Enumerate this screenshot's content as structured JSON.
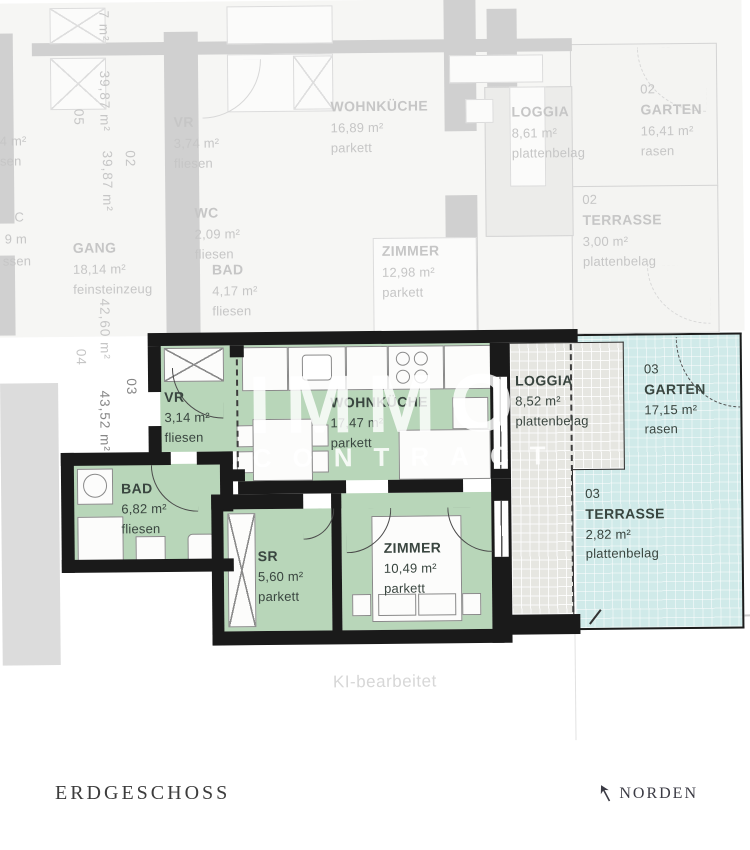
{
  "footer": {
    "floor_label": "ERDGESCHOSS",
    "north_label": "NORDEN"
  },
  "watermark": {
    "line1": "IMMO",
    "line2": "CONTRACT",
    "ai_note": "KI-bearbeitet"
  },
  "colors": {
    "room_green": "#b8d6b9",
    "outdoor_cyan": "#d0eae9",
    "loggia_gray": "#e6e6e1",
    "wall_black": "#1a1a1a"
  },
  "unit": {
    "number": "03",
    "total_area": "43,52 m²",
    "rooms": {
      "vr": {
        "name": "VR",
        "area": "3,14 m²",
        "floor": "fliesen"
      },
      "wohnkueche": {
        "name": "WOHNKÜCHE",
        "area": "17,47 m²",
        "floor": "parkett"
      },
      "loggia": {
        "name": "LOGGIA",
        "area": "8,52 m²",
        "floor": "plattenbelag"
      },
      "garten": {
        "unit": "03",
        "name": "GARTEN",
        "area": "17,15 m²",
        "floor": "rasen"
      },
      "terrasse": {
        "unit": "03",
        "name": "TERRASSE",
        "area": "2,82 m²",
        "floor": "plattenbelag"
      },
      "bad": {
        "name": "BAD",
        "area": "6,82 m²",
        "floor": "fliesen"
      },
      "sr": {
        "name": "SR",
        "area": "5,60 m²",
        "floor": "parkett"
      },
      "zimmer": {
        "name": "ZIMMER",
        "area": "10,49 m²",
        "floor": "parkett"
      }
    }
  },
  "faded": {
    "rooms": {
      "vr": {
        "name": "VR",
        "area": "3,74 m²",
        "floor": "fliesen"
      },
      "wc": {
        "name": "WC",
        "area": "2,09 m²",
        "floor": "fliesen"
      },
      "bad": {
        "name": "BAD",
        "area": "4,17 m²",
        "floor": "fliesen"
      },
      "gang": {
        "name": "GANG",
        "area": "18,14 m²",
        "floor": "feinsteinzeug"
      },
      "wohnkueche": {
        "name": "WOHNKÜCHE",
        "area": "16,89 m²",
        "floor": "parkett"
      },
      "zimmer": {
        "name": "ZIMMER",
        "area": "12,98 m²",
        "floor": "parkett"
      },
      "loggia": {
        "name": "LOGGIA",
        "area": "8,61 m²",
        "floor": "plattenbelag"
      },
      "garten": {
        "unit": "02",
        "name": "GARTEN",
        "area": "16,41 m²",
        "floor": "rasen"
      },
      "terrasse": {
        "unit": "02",
        "name": "TERRASSE",
        "area": "3,00 m²",
        "floor": "plattenbelag"
      }
    },
    "dimensions": {
      "unit05_number": "05",
      "unit05_area": "39,87 m²",
      "unit02_number": "02",
      "unit02_area": "39,87 m²",
      "unit04_number": "04",
      "unit04_area": "42,60 m²",
      "small_area": "7 m²"
    },
    "fragments": [
      "4 m²",
      "sen",
      "C",
      "9 m",
      "ssen"
    ]
  }
}
